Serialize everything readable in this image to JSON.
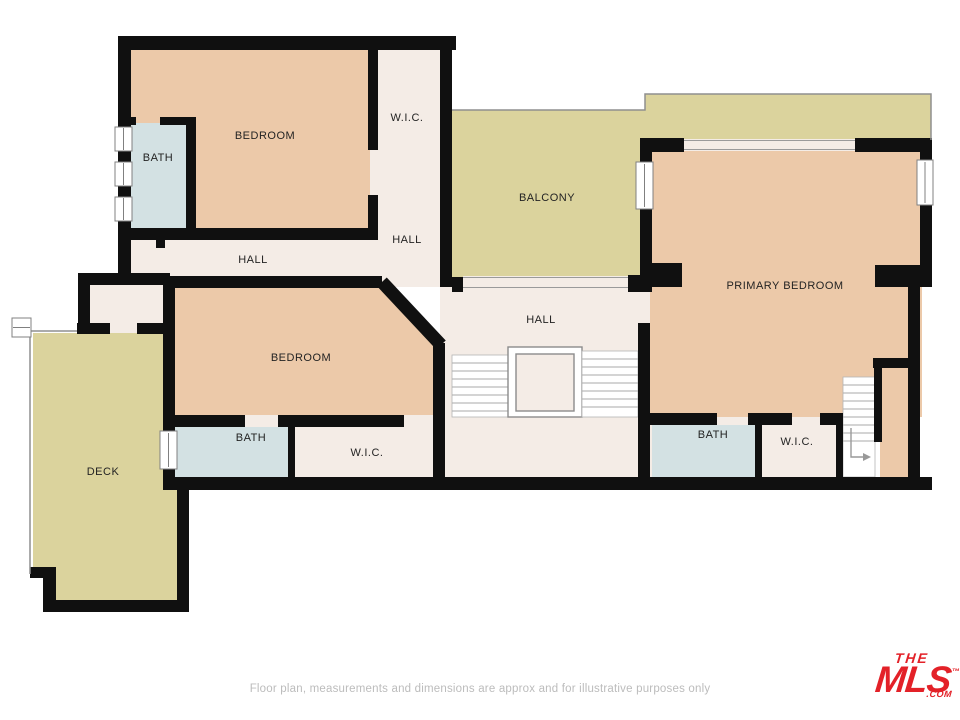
{
  "plan": {
    "labels": {
      "bedroom1": "BEDROOM",
      "bath1": "BATH",
      "wic1": "W.I.C.",
      "hall_upper": "HALL",
      "hall_left": "HALL",
      "hall_center": "HALL",
      "balcony": "BALCONY",
      "bedroom2": "BEDROOM",
      "bath2": "BATH",
      "wic2": "W.I.C.",
      "deck": "DECK",
      "primary_bedroom": "PRIMARY BEDROOM",
      "bath3": "BATH",
      "wic3": "W.I.C."
    }
  },
  "colors": {
    "wall": "#101010",
    "bedroom": "#ECC9A9",
    "bath": "#D3E1E3",
    "outdoor": "#DBD39D",
    "hall": "#F4ECE6",
    "stair": "#FFFFFF",
    "line": "#8F8F8F",
    "label": "#232323",
    "logo": "#E32128"
  },
  "footer": {
    "disclaimer": "Floor plan, measurements and dimensions are approx and for illustrative purposes only"
  },
  "logo": {
    "the": "THE",
    "mls": "MLS",
    "tm": "™",
    "com": ".COM"
  }
}
